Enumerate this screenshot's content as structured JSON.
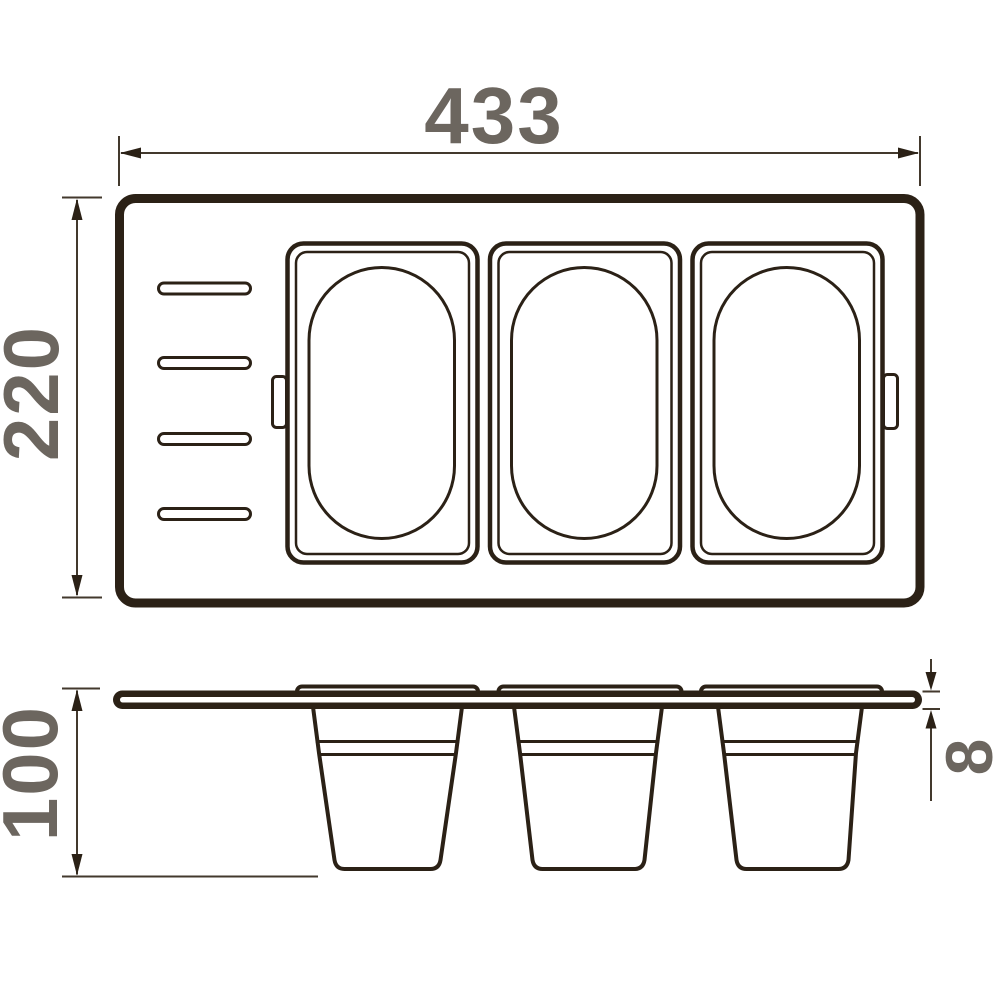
{
  "drawing": {
    "type": "technical-dimension-drawing",
    "subject": "drawer organizer tray with three removable containers, top view and side view",
    "dimensions": {
      "top_width": "433",
      "top_height": "220",
      "side_height": "100",
      "panel_thickness": "8"
    },
    "views": {
      "top_view": {
        "containers": 3,
        "slots": 4,
        "side_tabs": 2
      },
      "side_view": {
        "buckets": 3,
        "flanges": 3
      }
    },
    "colors": {
      "line": "#2b2116",
      "dimension_line": "#43392d",
      "dimension_text": "#6c665f",
      "background": "#ffffff"
    }
  }
}
